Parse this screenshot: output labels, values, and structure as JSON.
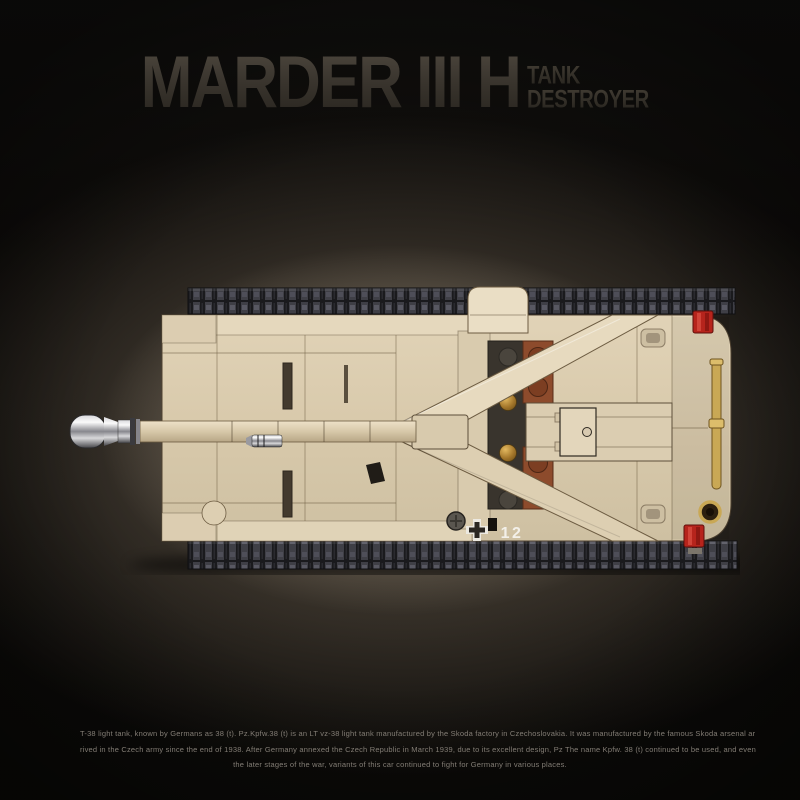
{
  "header": {
    "title": "MARDER III H",
    "subtitle": {
      "line1": "TANK",
      "line2": "DESTROYER"
    }
  },
  "tank": {
    "marking": "12"
  },
  "description": {
    "line1": "T-38 light tank, known by Germans as 38 (t). Pz.Kpfw.38 (t) is an LT vz-38 light tank manufactured by the Skoda factory in Czechoslovakia. It was manufactured by the famous Skoda arsenal ar",
    "line2": "rived in the Czech army since the end of 1938. After Germany annexed the Czech Republic in March 1939, due to its excellent design, Pz The name Kpfw. 38 (t) continued to be used, and even",
    "line3": "the later stages of the war, variants of this car continued to fight for Germany in various places."
  },
  "colors": {
    "background_glow": "#7b7061",
    "hull_tan": "#d9cbae",
    "track_dark": "#1a1a1d",
    "brown_brick": "#8d4b2c",
    "gold_detail": "#c9a855",
    "red_light": "#b6241c",
    "title_gray": "#3a352e",
    "marking_white": "#f3f0e9"
  }
}
